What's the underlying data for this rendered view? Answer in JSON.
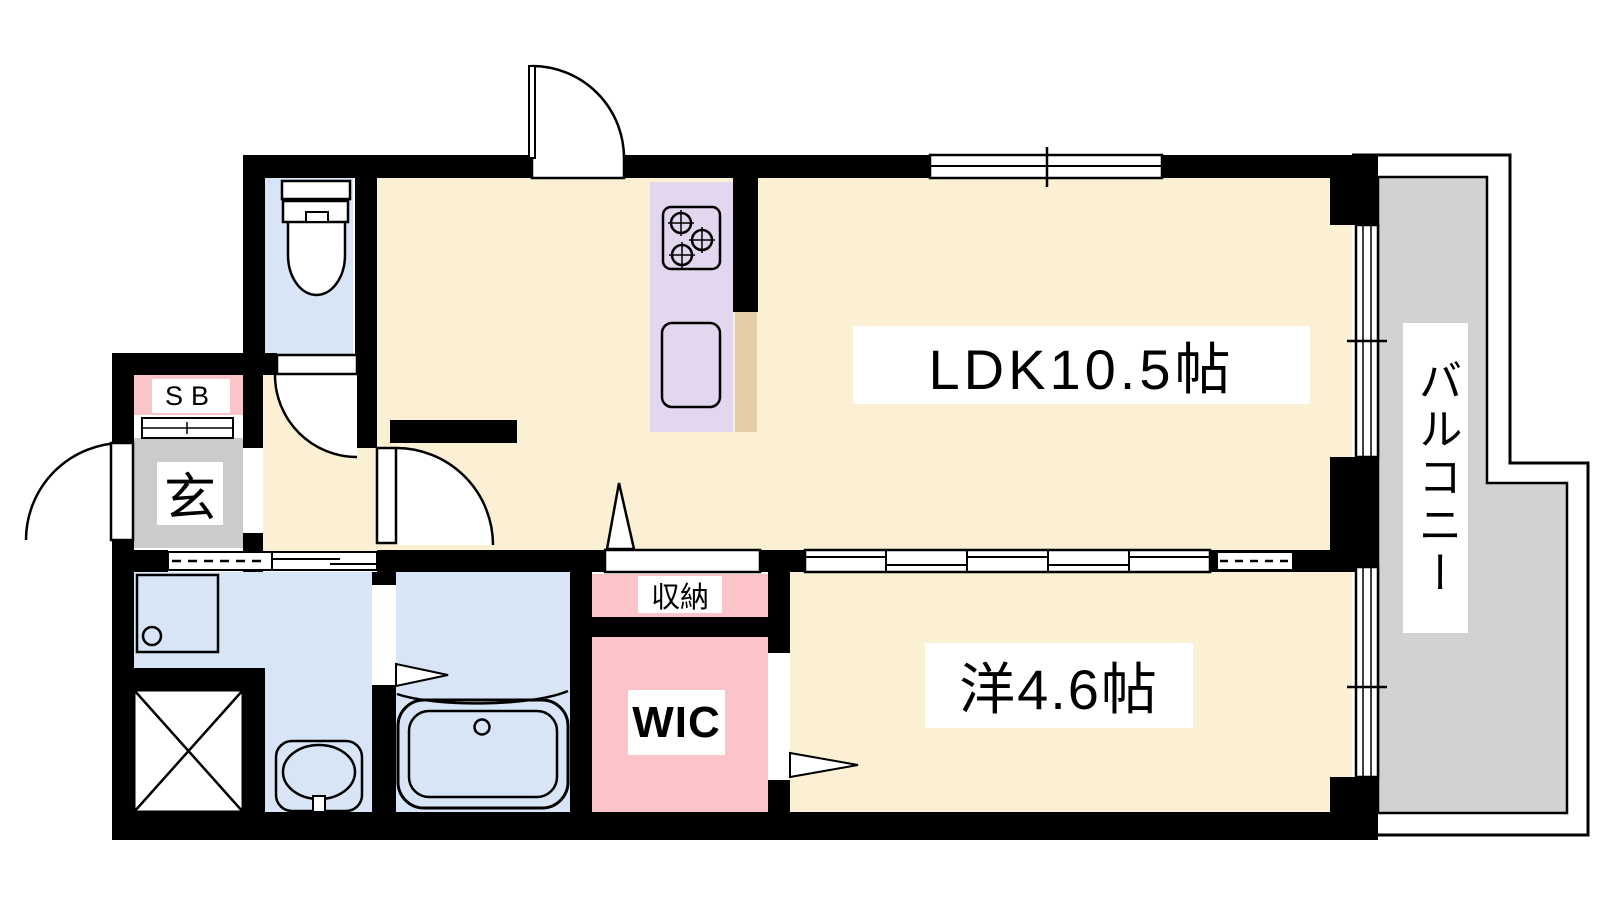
{
  "plan": {
    "type": "apartment-floor-plan",
    "rooms": {
      "ldk": {
        "label": "LDK10.5帖"
      },
      "western_room": {
        "label": "洋4.6帖"
      },
      "balcony": {
        "label": "バルコニー"
      },
      "entrance": {
        "label": "玄"
      },
      "shoe_box": {
        "label": "SB"
      },
      "storage": {
        "label": "収納"
      },
      "walk_in_closet": {
        "label": "WIC"
      }
    },
    "fixtures": [
      "toilet-icon",
      "bathtub-icon",
      "washbasin-icon",
      "kitchen-stove-icon",
      "kitchen-sink-icon",
      "washing-machine-pan-icon",
      "pipe-shaft-x-icon",
      "door-swing-icon",
      "sliding-door-icon",
      "window-icon"
    ],
    "colors": {
      "room_floor": "#FBF0D3",
      "wet_area_floor": "#D7E5F7",
      "closet_fill": "#FAC4C9",
      "entrance_floor": "#CBCBCB",
      "balcony_floor": "#D2D2D2",
      "kitchen_counter": "#E3D7F0",
      "counter_edge": "#E2CDA4",
      "wall": "#000000",
      "label_background": "#FFFFFF"
    }
  }
}
